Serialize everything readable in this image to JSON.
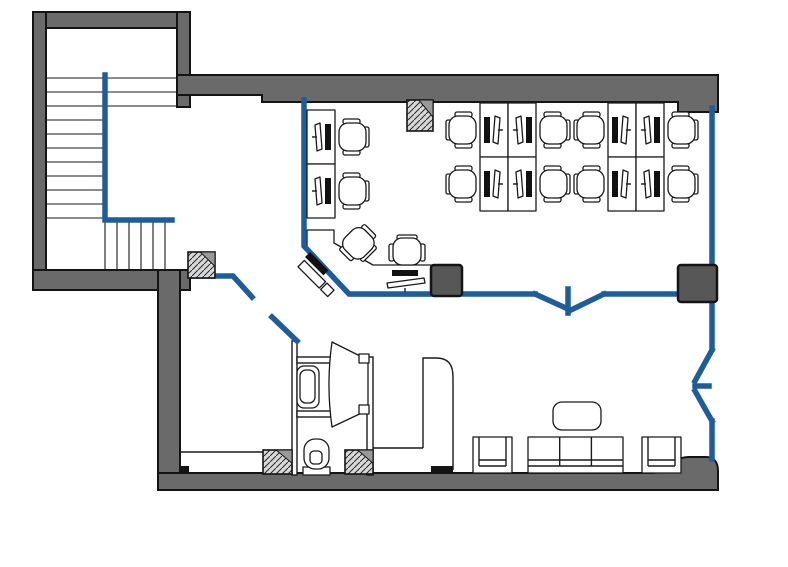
{
  "diagram": {
    "kind": "office-floor-plan",
    "rooms": [
      "stairwell",
      "open-plan-office",
      "entry-hall",
      "bathroom",
      "lounge"
    ],
    "workstation_count": 12,
    "lounge": {
      "sofa_seats": 3,
      "armchairs": 2,
      "coffee_tables": 1
    },
    "bathroom_fixtures": [
      "toilet",
      "sink"
    ]
  },
  "colors": {
    "background": "#ffffff",
    "wall": "#6a6a6a",
    "outline": "#141414",
    "glass_blue": "#1e5d9c",
    "column_dark": "#575757",
    "hatch_bg": "#d8d8d8",
    "hatch_line": "#2a2a2a",
    "corner_gray": "#999999",
    "line_black": "#1a1a1a"
  },
  "structure": {
    "wall_rects": [
      {
        "name": "stairwell-top-wall",
        "r": [
          33,
          12,
          157,
          16
        ]
      },
      {
        "name": "stairwell-left-wall",
        "r": [
          33,
          12,
          13,
          278
        ]
      },
      {
        "name": "stairwell-right-wall",
        "r": [
          177,
          12,
          13,
          95
        ]
      },
      {
        "name": "stairwell-bottom-wall",
        "r": [
          33,
          270,
          157,
          20
        ]
      },
      {
        "name": "west-wall-lower",
        "r": [
          158,
          270,
          22,
          203
        ]
      }
    ],
    "wall_paths": [
      {
        "name": "north-wall",
        "d": "M177,75 H718 V112 H678 V102 H262 V95 H177 Z"
      },
      {
        "name": "south-wall",
        "d": "M158,473 H652 C666,473 670,458 688,457 H706 C714,457 718,462 718,471 V490 H158 Z"
      }
    ],
    "wall_nubs": [
      [
        180,
        466,
        9,
        8
      ],
      [
        431,
        466,
        22,
        8
      ]
    ],
    "hatched_columns": [
      {
        "name": "column-stair-corner",
        "r": [
          188,
          252,
          27,
          26
        ]
      },
      {
        "name": "column-north-wall",
        "r": [
          407,
          100,
          26,
          31
        ]
      },
      {
        "name": "column-bath-west",
        "r": [
          263,
          450,
          29,
          24
        ]
      },
      {
        "name": "column-bath-east",
        "r": [
          345,
          450,
          28,
          24
        ]
      }
    ],
    "solid_columns": [
      {
        "name": "column-center",
        "r": [
          431,
          265,
          31,
          31
        ]
      },
      {
        "name": "column-east",
        "r": [
          678,
          265,
          39,
          37
        ]
      }
    ],
    "glass_partitions": [
      {
        "name": "stair-rail",
        "pts": [
          [
            105,
            75
          ],
          [
            105,
            220
          ],
          [
            172,
            220
          ]
        ]
      },
      {
        "name": "office-west-partition",
        "pts": [
          [
            304,
            100
          ],
          [
            304,
            246
          ],
          [
            349,
            294
          ],
          [
            535,
            294
          ]
        ]
      },
      {
        "name": "office-door-leaf-a",
        "pts": [
          [
            535,
            294
          ],
          [
            568,
            309
          ]
        ]
      },
      {
        "name": "office-door-stub",
        "pts": [
          [
            568,
            289
          ],
          [
            568,
            313
          ]
        ]
      },
      {
        "name": "office-door-leaf-b",
        "pts": [
          [
            569,
            311
          ],
          [
            604,
            294
          ]
        ]
      },
      {
        "name": "office-south-partition",
        "pts": [
          [
            604,
            294
          ],
          [
            680,
            294
          ]
        ]
      },
      {
        "name": "east-glass-wall-upper",
        "pts": [
          [
            712,
            108
          ],
          [
            712,
            266
          ]
        ]
      },
      {
        "name": "east-glass-wall-mid",
        "pts": [
          [
            712,
            300
          ],
          [
            712,
            349
          ]
        ]
      },
      {
        "name": "east-door-leaf-a",
        "pts": [
          [
            712,
            350
          ],
          [
            695,
            381
          ]
        ]
      },
      {
        "name": "east-door-stub",
        "pts": [
          [
            695,
            386
          ],
          [
            709,
            386
          ]
        ]
      },
      {
        "name": "east-door-leaf-b",
        "pts": [
          [
            695,
            391
          ],
          [
            712,
            421
          ]
        ]
      },
      {
        "name": "east-glass-wall-lower",
        "pts": [
          [
            712,
            421
          ],
          [
            712,
            459
          ]
        ]
      },
      {
        "name": "entry-partition",
        "pts": [
          [
            190,
            276
          ],
          [
            233,
            276
          ],
          [
            252,
            297
          ]
        ]
      },
      {
        "name": "entry-door-leaf",
        "pts": [
          [
            272,
            317
          ],
          [
            297,
            341
          ]
        ]
      }
    ],
    "thin_wall_rects": [
      {
        "name": "bathroom-west-wall",
        "r": [
          292,
          341,
          5,
          134
        ]
      },
      {
        "name": "sink-alcove-top-wall",
        "r": [
          297,
          357,
          35,
          6
        ]
      },
      {
        "name": "sink-alcove-bottom-wall",
        "r": [
          297,
          411,
          35,
          6
        ]
      },
      {
        "name": "bathroom-east-wall",
        "r": [
          367,
          357,
          6,
          118
        ]
      }
    ],
    "thin_lines": [
      {
        "name": "bench-line",
        "l": [
          180,
          452,
          263,
          452
        ]
      },
      {
        "name": "vestibule-line",
        "l": [
          373,
          448,
          423,
          448
        ]
      }
    ],
    "thin_paths": [
      {
        "name": "reception-wall",
        "d": "M423,448 V358 H436 C448,358 453,364 453,377 V470"
      }
    ],
    "door_funnel": {
      "d": "M332,342 L368,360 L368,410 L332,427 C328,399 328,370 332,342 Z",
      "hinges": [
        [
          359,
          354,
          10,
          9
        ],
        [
          359,
          405,
          10,
          9
        ]
      ]
    }
  },
  "stairs": {
    "long_treads_y": [
      78,
      92,
      106
    ],
    "long_x": [
      46,
      177
    ],
    "short_treads_y": [
      120,
      134,
      148,
      162,
      176,
      190,
      204,
      218
    ],
    "short_x": [
      46,
      105
    ],
    "risers_x": [
      105,
      117,
      129,
      141,
      153,
      165
    ],
    "risers_y": [
      222,
      270
    ]
  },
  "furniture": {
    "workstations": [
      {
        "x": 446,
        "y": 103,
        "mirror": false
      },
      {
        "x": 446,
        "y": 157,
        "mirror": false
      },
      {
        "x": 570,
        "y": 103,
        "mirror": true
      },
      {
        "x": 570,
        "y": 157,
        "mirror": true
      },
      {
        "x": 574,
        "y": 103,
        "mirror": false
      },
      {
        "x": 574,
        "y": 157,
        "mirror": false
      },
      {
        "x": 698,
        "y": 103,
        "mirror": true
      },
      {
        "x": 698,
        "y": 157,
        "mirror": true
      },
      {
        "x": 369,
        "y": 110,
        "mirror": true
      },
      {
        "x": 369,
        "y": 164,
        "mirror": true
      }
    ],
    "corner_desk_path": "M307,230 H334 V243 L373,265 H431 V296 H349 L307,249 Z",
    "extra_chairs": [
      {
        "cx": 358,
        "cy": 243,
        "rot": 225
      },
      {
        "cx": 407,
        "cy": 252,
        "rot": 90
      }
    ],
    "desk_equipment": [
      {
        "sym": "papers",
        "x": 310,
        "y": 252,
        "rot": 45
      },
      {
        "sym": "equip",
        "x": 387,
        "y": 270,
        "rot": 0
      }
    ],
    "sink": {
      "x": 297,
      "y": 366
    },
    "toilet": {
      "x": 303,
      "y": 439
    },
    "armchairs": [
      [
        473,
        437
      ],
      [
        642,
        437
      ]
    ],
    "sofa": {
      "r": [
        528,
        437,
        95,
        36
      ]
    },
    "coffee_table": {
      "r": [
        553,
        402,
        48,
        28
      ]
    }
  }
}
